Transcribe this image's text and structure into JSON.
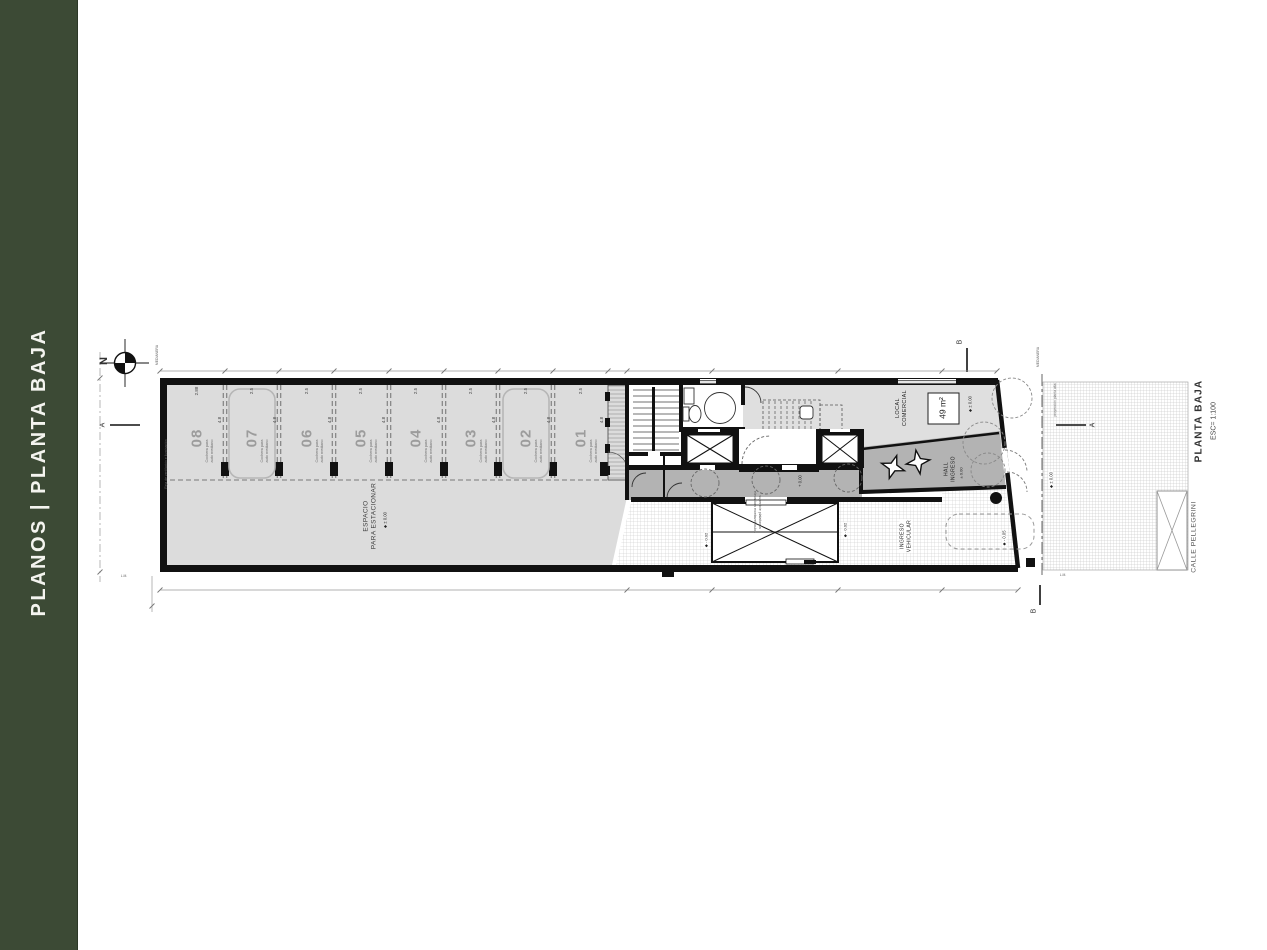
{
  "sidebar": {
    "title": "PLANOS | PLANTA BAJA",
    "bg": "#3c4a35"
  },
  "plan": {
    "title": "PLANTA BAJA",
    "scale": "ESC= 1:100",
    "street": "CALLE PELLEGRINI",
    "north_label": "N",
    "section_markers": {
      "a_left": "A",
      "a_right": "A",
      "b_top": "B",
      "b_bottom": "B"
    },
    "parking": {
      "area_label": "ESPACIO\nPARA ESTACIONAR",
      "area_level": "◆ ± 0.00",
      "vent_label": "Reja de ventilación e iluminación",
      "stall_note": "Cochera para\nauto mediano",
      "depth_dim": "4.8",
      "stalls": [
        {
          "number": "08",
          "width_dim": "2.88"
        },
        {
          "number": "07",
          "width_dim": "2.5"
        },
        {
          "number": "06",
          "width_dim": "2.5"
        },
        {
          "number": "05",
          "width_dim": "2.5"
        },
        {
          "number": "04",
          "width_dim": "2.5"
        },
        {
          "number": "03",
          "width_dim": "2.5"
        },
        {
          "number": "02",
          "width_dim": "2.5"
        },
        {
          "number": "01",
          "width_dim": "2.5"
        }
      ]
    },
    "local_comercial": {
      "label": "LOCAL\nCOMERCIAL",
      "area": "49 m²",
      "level": "◆ ± 0.00"
    },
    "hall": {
      "label": "HALL\nINGRESO",
      "level": "± 0.00"
    },
    "corridor_level": "+ 0.00",
    "vehicle_entry": {
      "label": "INGRESO\nVEHICULAR",
      "level": "◆ - 0.05"
    },
    "platform": {
      "note": "superficie plataforma\nelevadora montavehículos",
      "level_left": "◆ - 0.02",
      "level_right": "◆ - 0.02"
    },
    "sidewalk_level": "◆ ± 0.00",
    "annotations": {
      "medianera_left": "MEDIANERA",
      "medianera_right": "MEDIANERA",
      "projection": "proyección planta alta",
      "lm_left": "L.M.",
      "lm_right": "L.M."
    }
  }
}
